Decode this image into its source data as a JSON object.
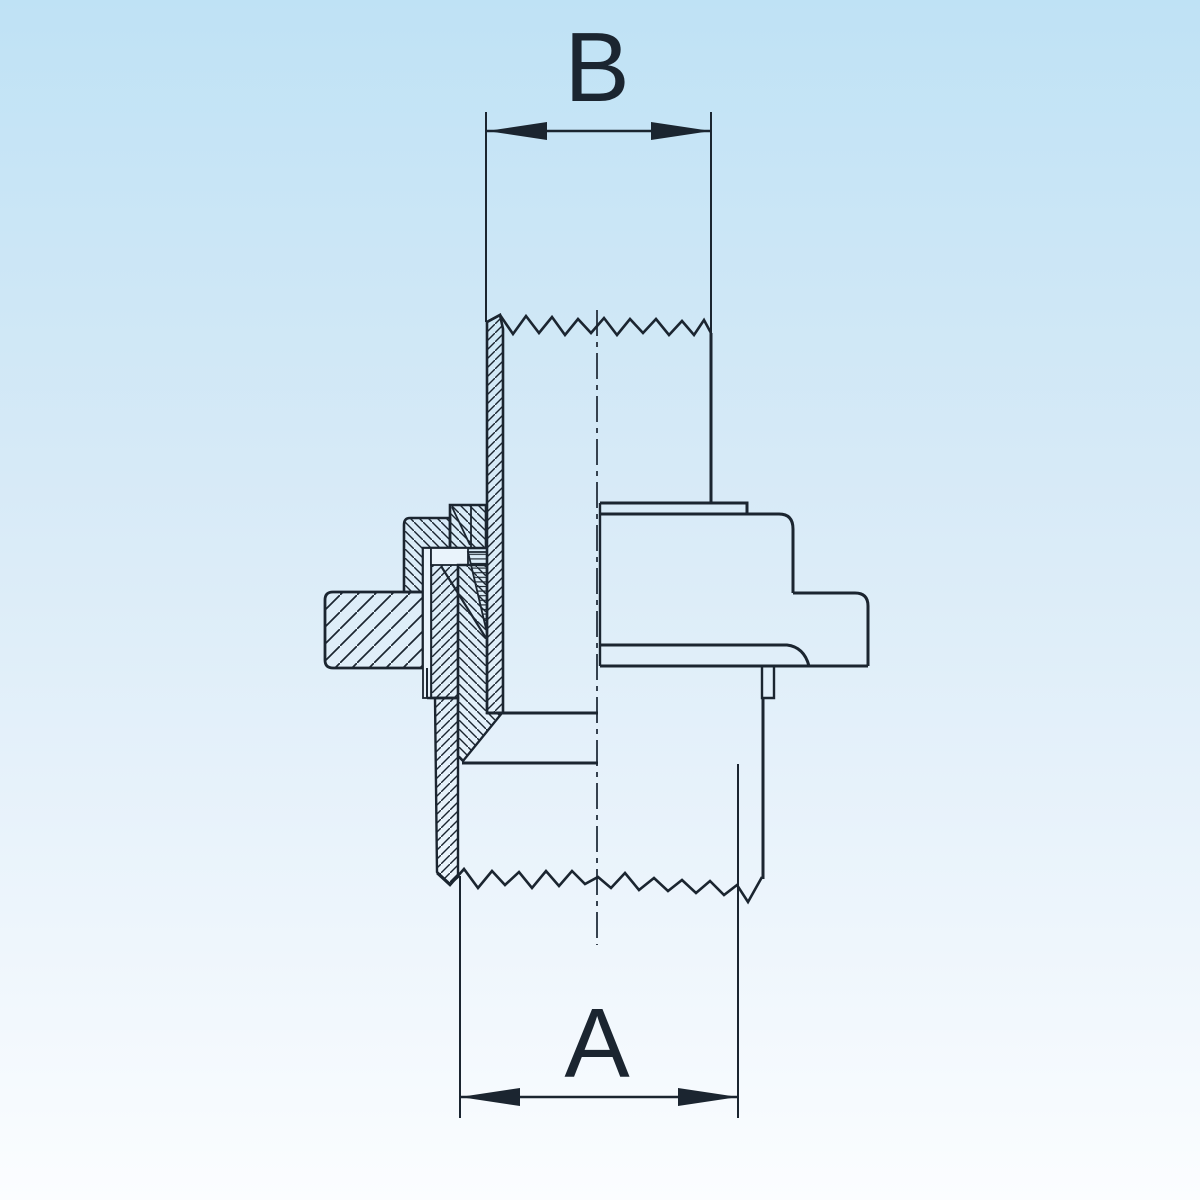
{
  "drawing": {
    "kind": "pipe-union-cross-section",
    "dimensions": {
      "top_label": "B",
      "bottom_label": "A"
    },
    "colors": {
      "line": "#1b2530",
      "background_top": "#bfe2f5",
      "background_bottom": "#fbfdff",
      "section_gap_fill": "#e9f3fb"
    }
  }
}
